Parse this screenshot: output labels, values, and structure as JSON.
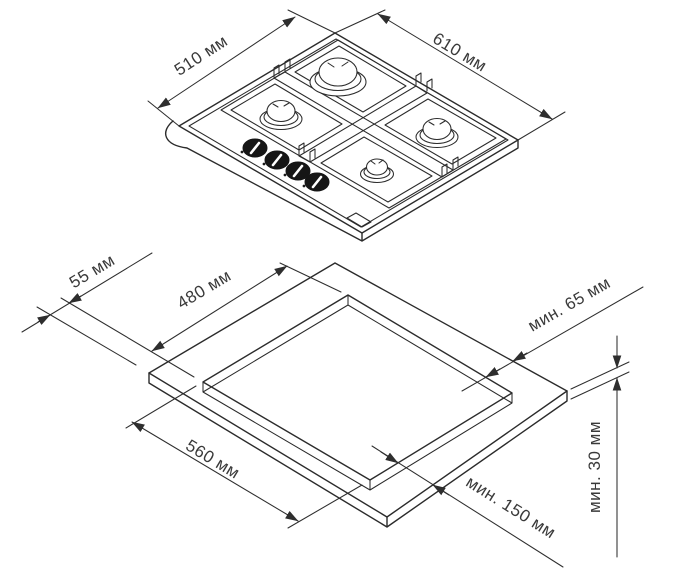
{
  "diagram": {
    "type": "hob-installation-dimensions-drawing",
    "background": "#ffffff",
    "line_color": "#2b2b2b",
    "text_color": "#3a3a3a",
    "hob_view": {
      "depth_label": "510 мм",
      "width_label": "610 мм",
      "burner_count": 4,
      "knob_count": 4
    },
    "cutout_view": {
      "front_offset_label": "55 мм",
      "cutout_depth_label": "480 мм",
      "rear_clearance_label": "мин. 65 мм",
      "cutout_width_label": "560 мм",
      "side_clearance_label": "мин. 150 мм",
      "worktop_thickness_label": "мин. 30 мм"
    }
  }
}
